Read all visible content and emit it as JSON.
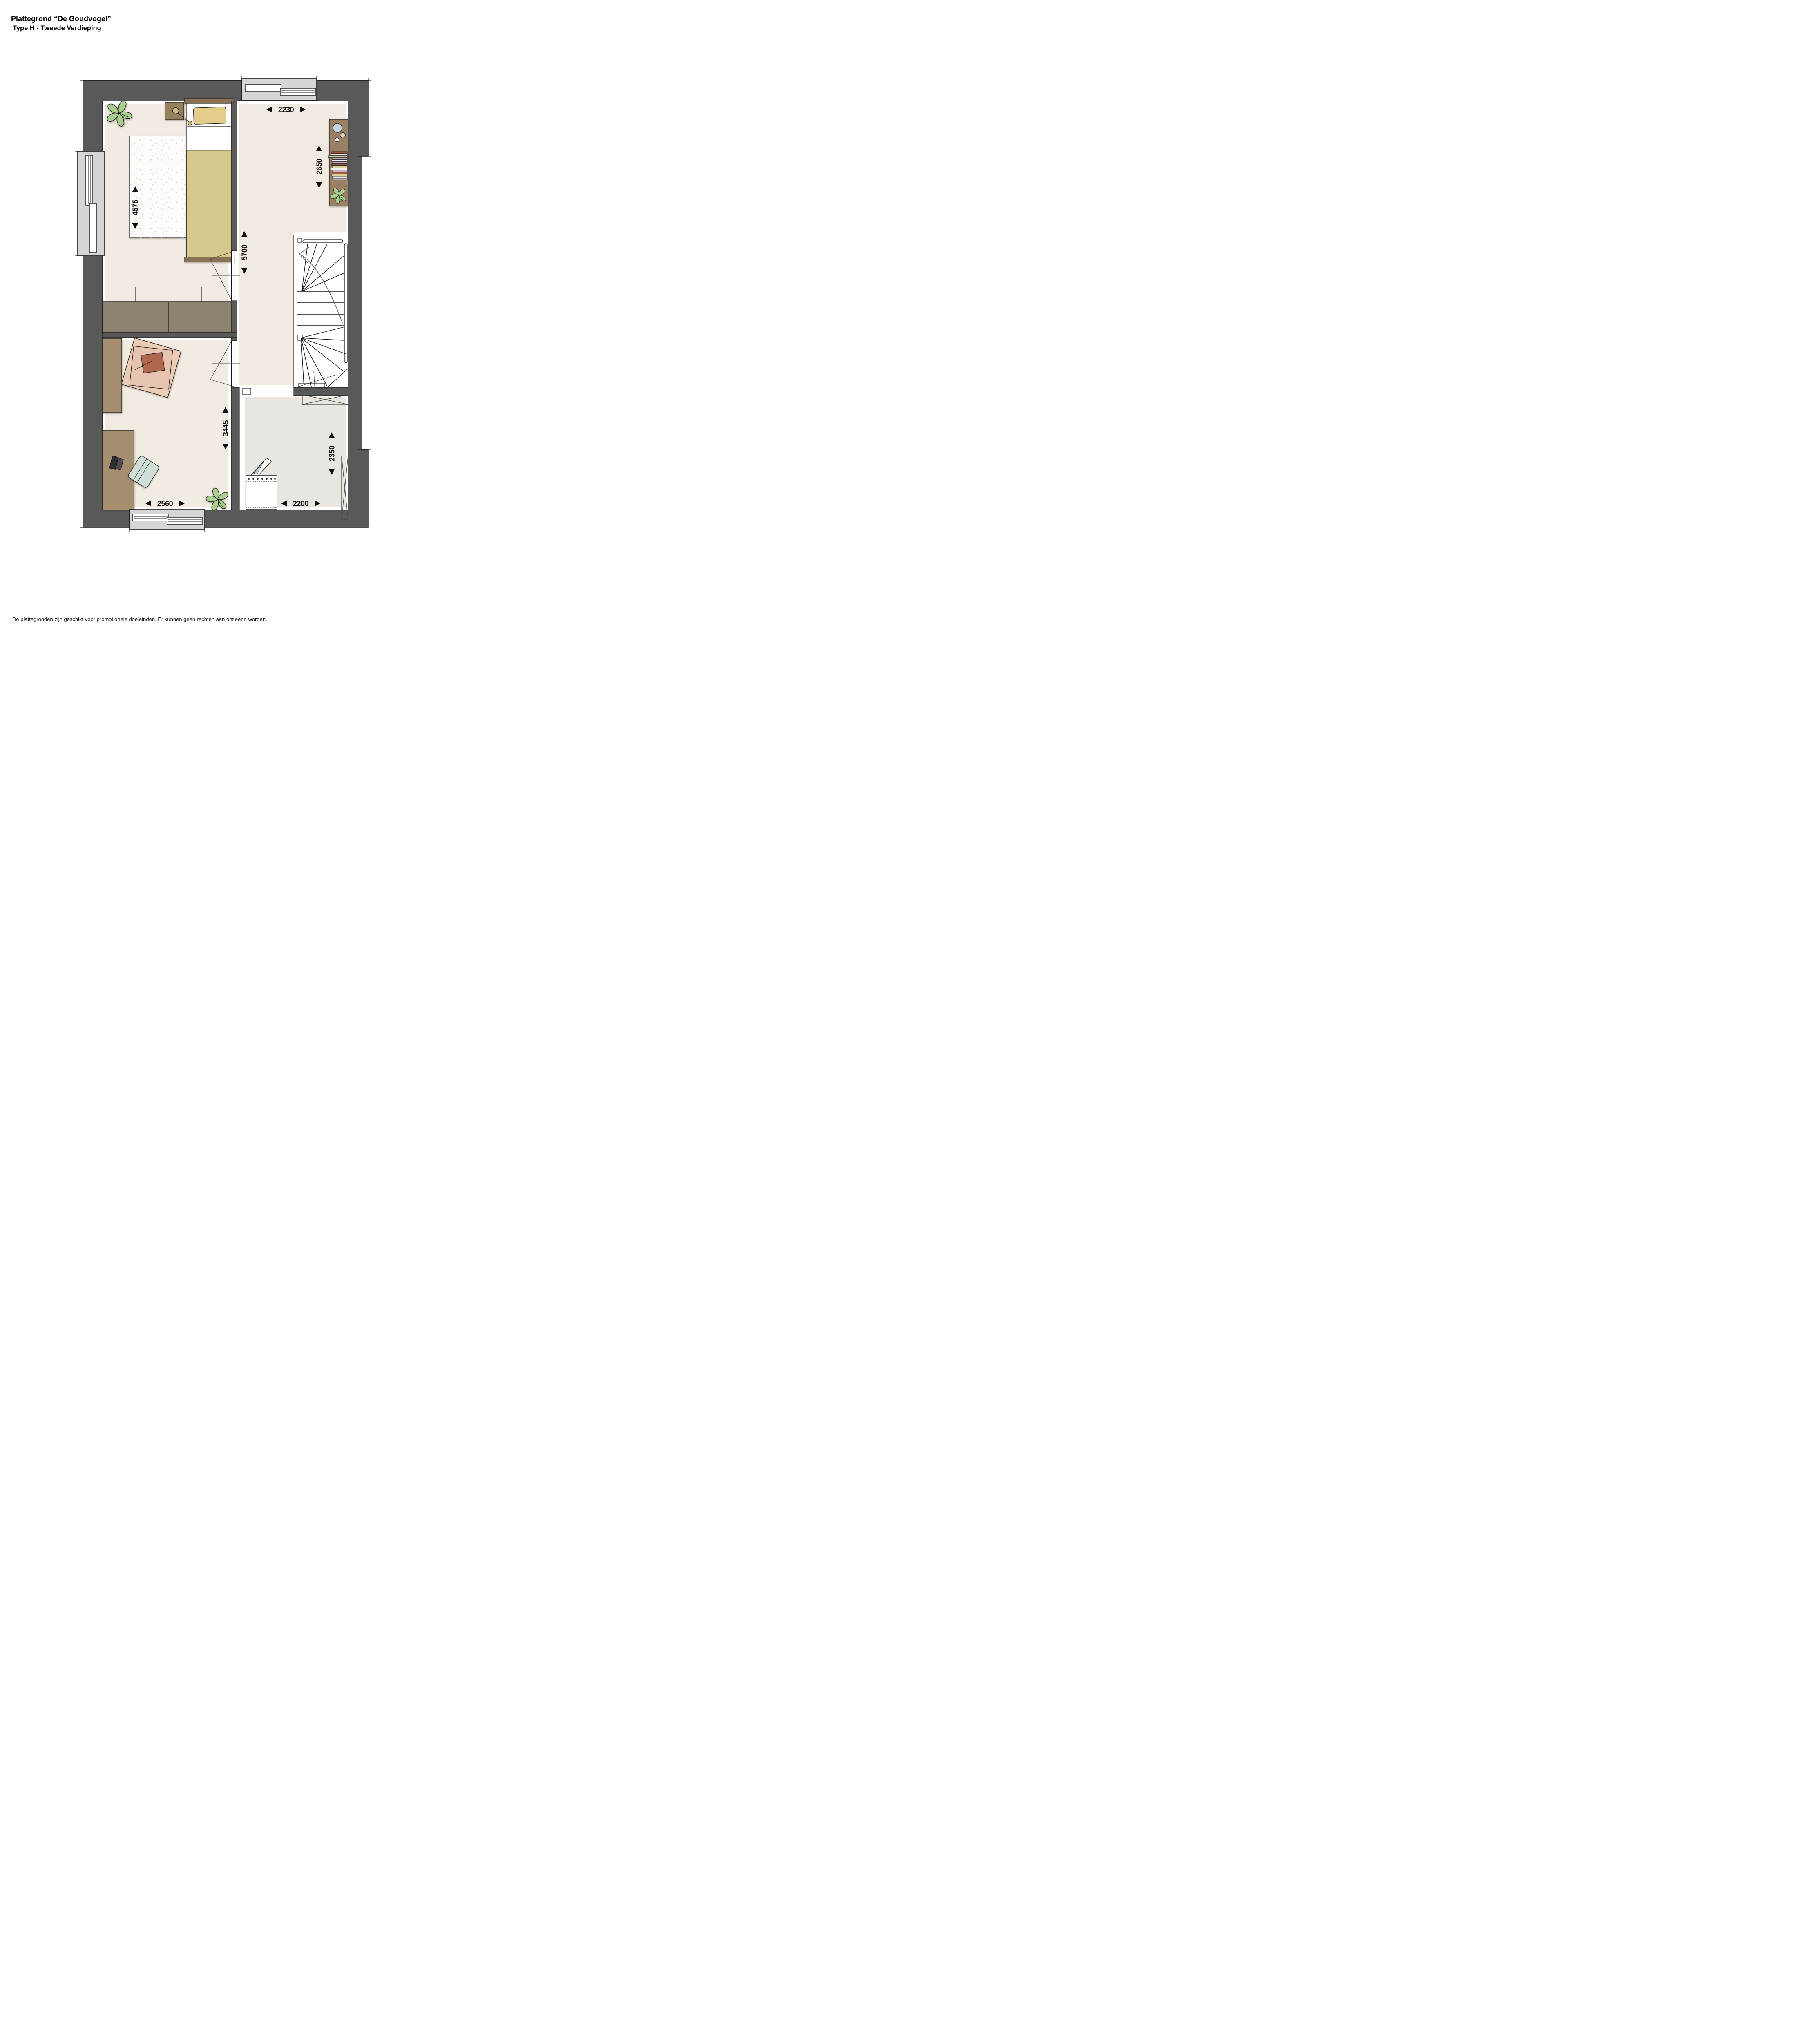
{
  "page": {
    "title_line1": "Plattegrond “De Goudvogel”",
    "title_line2": "Type H - Tweede Verdieping",
    "footer": "De plattegronden zijn geschikt voor promotionele doeleinden. Er kunnen geen rechten aan ontleend worden."
  },
  "floorplan": {
    "dimensions": {
      "hall_width": "2230",
      "landing_depth": "2650",
      "bedroom_depth": "4575",
      "bedroom_hall_depth": "5700",
      "office_depth": "3445",
      "laundry_depth": "2350",
      "office_width": "2560",
      "laundry_width": "2200"
    }
  },
  "theme": {
    "c-wall": "#595959",
    "c-recess": "#d6d6d6",
    "c-floor": "#f1ebe2",
    "c-hall": "#f0eae1",
    "c-laundry": "#e9e5e1",
    "c-wood": "#a58f70",
    "c-wood-dark": "#96805e",
    "c-wardrobe": "#8e8371",
    "c-shelf": "#9b8164",
    "c-blanket": "#d9c88e",
    "c-pillow": "#e4cd8b",
    "c-headboard": "#8a7355",
    "c-plant": "#a8cf8d",
    "c-chair": "#cfdfd7",
    "c-rug-pink": "#ecccb5",
    "c-terracotta": "#b0674e"
  }
}
